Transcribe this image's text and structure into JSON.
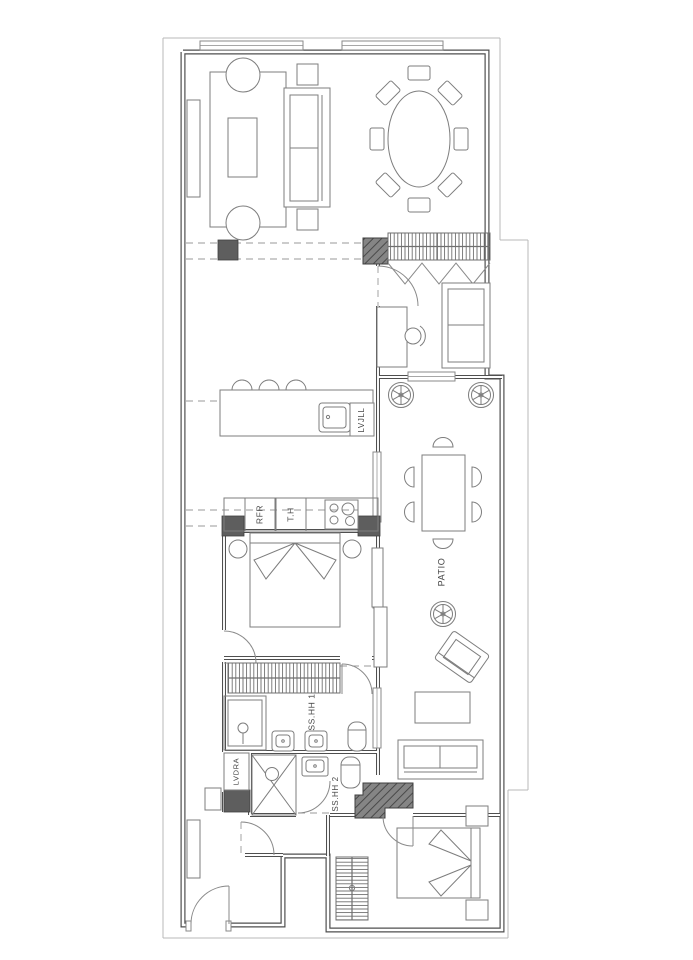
{
  "drawing": {
    "kind_label": "apartment floor plan",
    "colors": {
      "background": "#ffffff",
      "wall": "#4f4f4f",
      "furniture_line": "#7d7d7d",
      "column_fill": "#5e5e5e",
      "faint_line": "#b8b8b8",
      "dash_line": "#9a9a9a",
      "label_text": "#474747"
    },
    "rooms": {
      "kitchen": {
        "island_label": "LVJLL",
        "fridge_label": "RFR",
        "tall_unit_label": "T.H"
      },
      "bathroom1": {
        "label": "SS.HH 1"
      },
      "laundry": {
        "label": "LVDRA"
      },
      "bathroom2": {
        "label": "SS.HH 2"
      },
      "patio": {
        "label": "PATIO"
      },
      "bedroom2": {
        "label": "DORM 2"
      }
    }
  }
}
